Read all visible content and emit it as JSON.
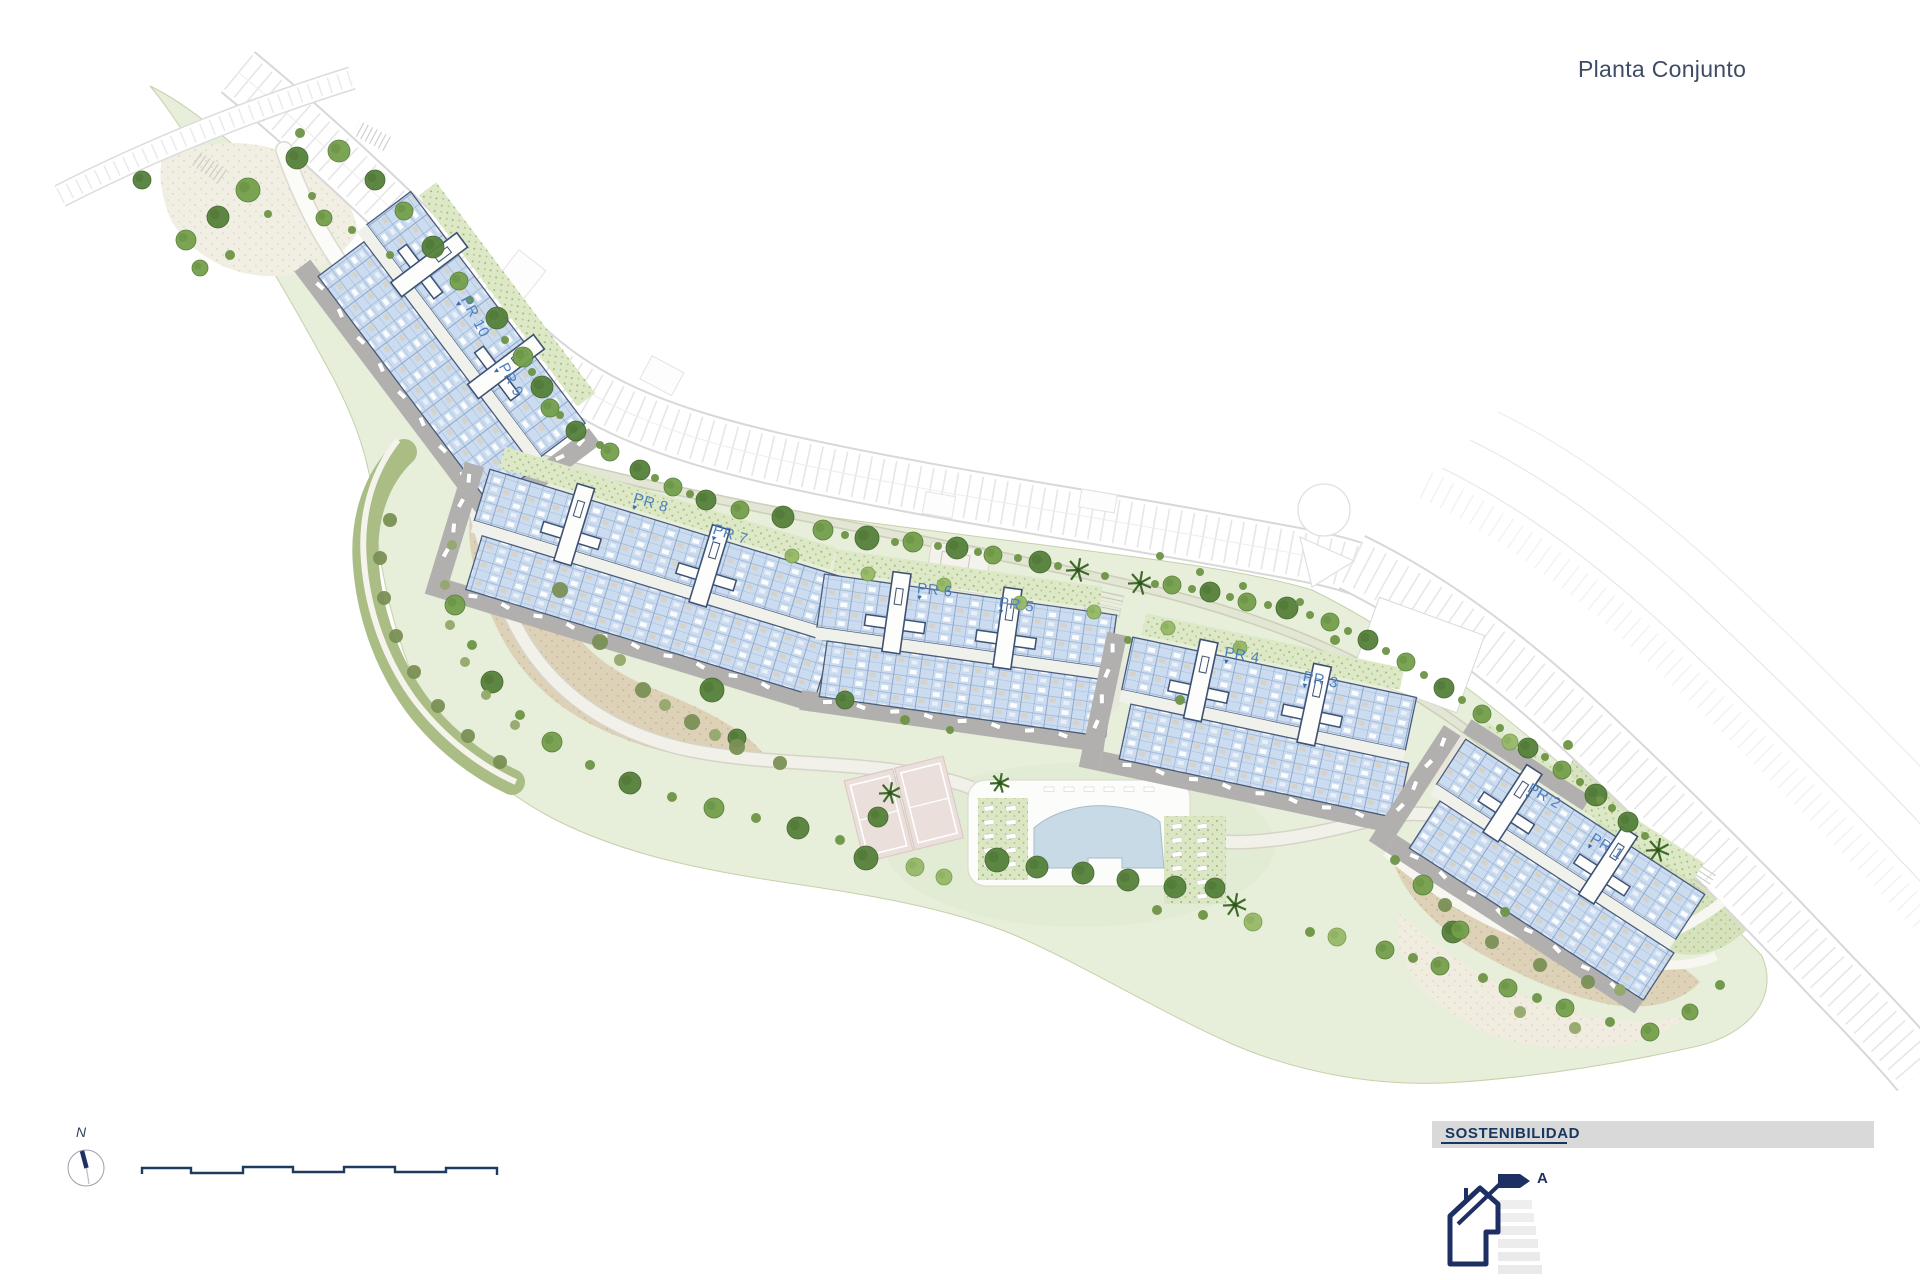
{
  "header": {
    "title": "Planta Conjunto"
  },
  "plan": {
    "label_color": "#4d7fc0",
    "building_labels": [
      {
        "label": "PR 10",
        "x": 472,
        "y": 293,
        "rot": 62
      },
      {
        "label": "PR 9",
        "x": 510,
        "y": 360,
        "rot": 62
      },
      {
        "label": "PR 8",
        "x": 636,
        "y": 490,
        "rot": 16
      },
      {
        "label": "PR 7",
        "x": 716,
        "y": 521,
        "rot": 18
      },
      {
        "label": "PR 6",
        "x": 918,
        "y": 580,
        "rot": 6
      },
      {
        "label": "PR 5",
        "x": 1000,
        "y": 594,
        "rot": 8
      },
      {
        "label": "PR 4",
        "x": 1226,
        "y": 644,
        "rot": 10
      },
      {
        "label": "PR 3",
        "x": 1305,
        "y": 668,
        "rot": 12
      },
      {
        "label": "PR 2",
        "x": 1533,
        "y": 780,
        "rot": 30
      },
      {
        "label": "PR 1",
        "x": 1596,
        "y": 830,
        "rot": 32
      }
    ]
  },
  "footer": {
    "north_label": "N",
    "sustainability": {
      "header": "SOSTENIBILIDAD",
      "rating": "A"
    }
  },
  "colors": {
    "title": "#3d4c66",
    "site_green": "#e7eeda",
    "building_blue": "#cbdcf0",
    "navy": "#1e2f63",
    "label_blue": "#4d7fc0",
    "sand": "#ddd2b8",
    "pool_blue": "#c8dae5"
  }
}
